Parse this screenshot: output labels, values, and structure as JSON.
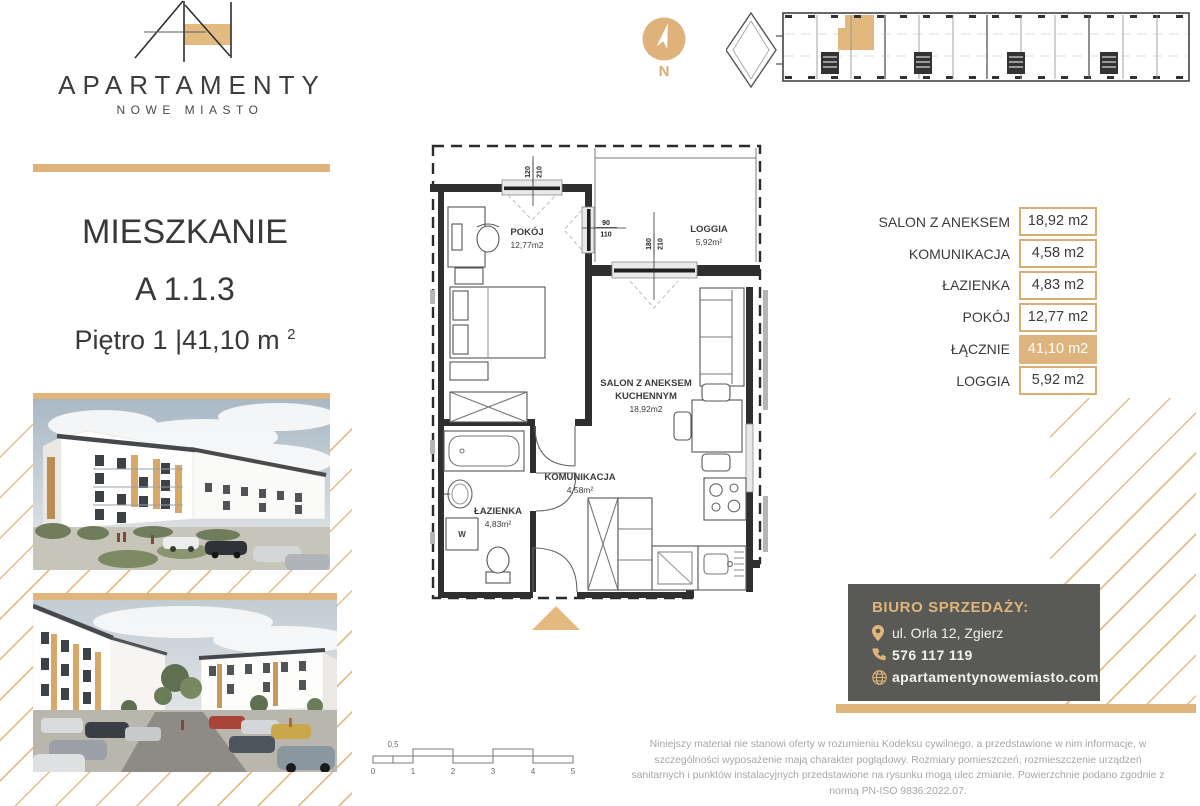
{
  "colors": {
    "gold": "#DFB57C",
    "gold_highlight": "#DEB47E",
    "contact_bg": "#595955",
    "text_dark": "#3a3a3a"
  },
  "logo": {
    "title": "APARTAMENTY",
    "subtitle": "NOWE MIASTO"
  },
  "unit": {
    "heading": "MIESZKANIE",
    "code": "A 1.1.3",
    "floor": "Piętro 1",
    "area": " |41,10 m",
    "area_sup": "2"
  },
  "compass": {
    "label": "N"
  },
  "floor_plan": {
    "rooms": {
      "pokoj": {
        "name": "POKÓJ",
        "area": "12,77m2"
      },
      "loggia": {
        "name": "LOGGIA",
        "area": "5,92m²"
      },
      "salon": {
        "line1": "SALON Z ANEKSEM",
        "line2": "KUCHENNYM",
        "area": "18,92m2"
      },
      "komunikacja": {
        "name": "KOMUNIKACJA",
        "area": "4,58m²"
      },
      "lazienka": {
        "name": "ŁAZIENKA",
        "area": "4,83m²"
      }
    },
    "washer": "W",
    "dims": {
      "win1_top": "120",
      "win1_bot": "210",
      "win2_top": "90",
      "win2_bot": "110",
      "door_top": "180",
      "door_bot": "210"
    }
  },
  "area_table": {
    "rows": [
      {
        "label": "SALON Z ANEKSEM",
        "value": "18,92 m2"
      },
      {
        "label": "KOMUNIKACJA",
        "value": "4,58 m2"
      },
      {
        "label": "ŁAZIENKA",
        "value": "4,83 m2"
      },
      {
        "label": "POKÓJ",
        "value": "12,77 m2"
      },
      {
        "label": "ŁĄCZNIE",
        "value": "41,10 m2"
      },
      {
        "label": "LOGGIA",
        "value": "5,92 m2"
      }
    ]
  },
  "scale": {
    "labels": [
      "0",
      "1",
      "2",
      "3",
      "4",
      "5"
    ],
    "half": "0,5"
  },
  "contact": {
    "heading": "BIURO SPRZEDAŻY:",
    "address": "ul. Orla 12, Zgierz",
    "phone": "576 117 119",
    "website": "apartamentynowemiasto.com"
  },
  "disclaimer": {
    "text": "Niniejszy materiał nie stanowi oferty w rozumieniu Kodeksu cywilnego, a przedstawione w nim informacje, w szczególności wyposażenie mają charakter poglądowy. Rozmiary pomieszczeń, rozmieszczenie urządzeń sanitarnych i punktów instalacyjnych przedstawione na rysunku mogą ulec zmianie. Powierzchnie podano zgodnie z normą PN-ISO 9836:2022.07."
  }
}
